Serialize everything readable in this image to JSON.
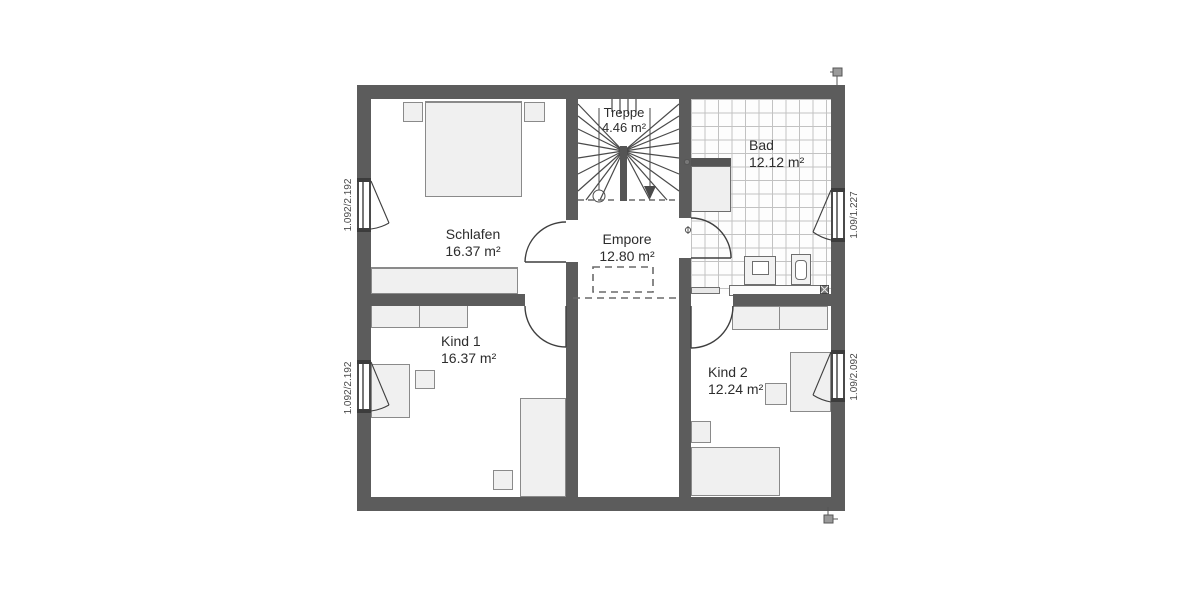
{
  "plan_title": "Obergeschoss Grundriss",
  "rooms": {
    "schlafen": {
      "name": "Schlafen",
      "area": "16.37 m²"
    },
    "treppe": {
      "name": "Treppe",
      "area": "4.46 m²"
    },
    "bad": {
      "name": "Bad",
      "area": "12.12 m²"
    },
    "empore": {
      "name": "Empore",
      "area": "12.80 m²"
    },
    "kind1": {
      "name": "Kind 1",
      "area": "16.37 m²"
    },
    "kind2": {
      "name": "Kind 2",
      "area": "12.24 m²"
    }
  },
  "window_dimensions": {
    "left_top": "1.092/2.192",
    "left_bottom": "1.092/2.192",
    "right_top": "1.09/1.227",
    "right_bottom": "1.09/2.092"
  },
  "icons": {
    "stair_walk_start": "circle-marker",
    "stair_walk_end": "triangle-down-arrow",
    "corner_top_right": "utility-marker",
    "corner_bottom_right": "utility-marker",
    "bathroom_valves": "valve-symbol",
    "floor_drain": "drain-square"
  },
  "colors": {
    "wall": "#5c5c5c",
    "line": "#3f3f3f",
    "furniture_fill": "#f0f0f0",
    "furniture_border": "#8a8a8a",
    "tile_line": "#c2c2c2",
    "text": "#2d2d2d"
  }
}
